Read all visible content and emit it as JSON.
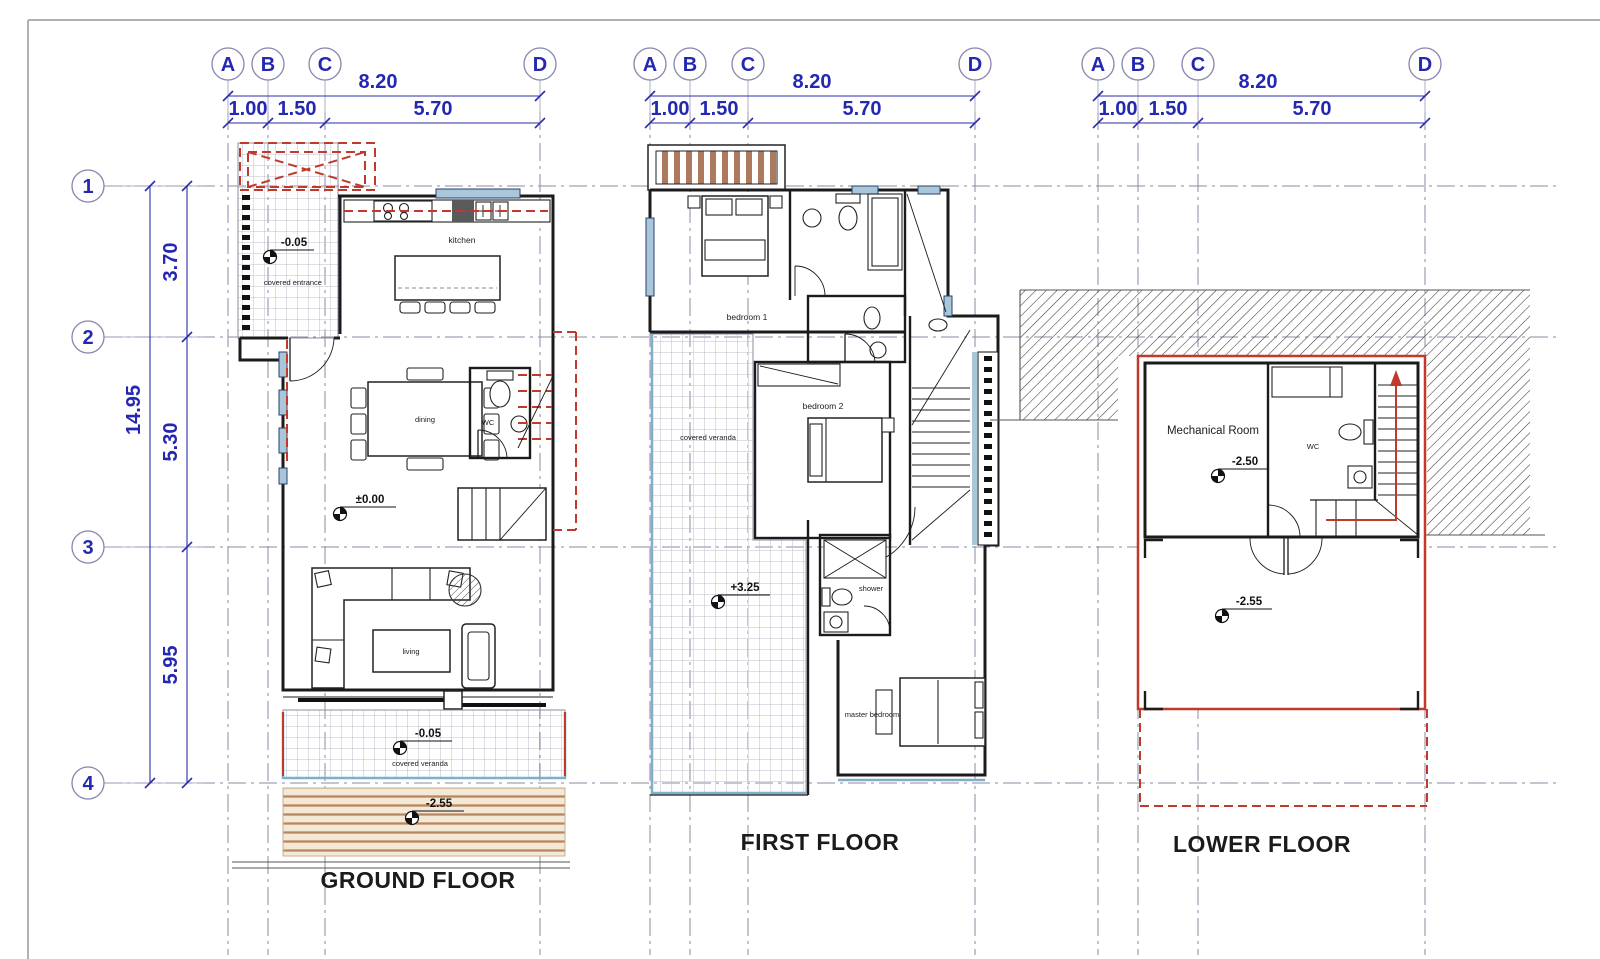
{
  "colors": {
    "dimension_blue": "#2427b2",
    "grid_dashdot": "#8b8ba6",
    "wall_black": "#1b1b1b",
    "red_accent": "#c0392b",
    "window_blue": "#a9c7d8",
    "veranda_blue": "#7fb0c8",
    "wood_tan": "#b5805a",
    "deck_cream": "#f4e8d7"
  },
  "grid": {
    "columns": [
      "A",
      "B",
      "C",
      "D"
    ],
    "rows": [
      "1",
      "2",
      "3",
      "4"
    ],
    "column_dims": {
      "total": "8.20",
      "segments": [
        "1.00",
        "1.50",
        "5.70"
      ]
    },
    "row_dims": {
      "total": "14.95",
      "segments": [
        "3.70",
        "5.30",
        "5.95"
      ]
    }
  },
  "floors": {
    "ground": {
      "title": "GROUND FLOOR",
      "rooms": {
        "kitchen": "kitchen",
        "dining": "dining",
        "wc": "WC",
        "living": "living",
        "covered_entrance": "covered entrance",
        "covered_veranda": "covered veranda"
      },
      "levels": {
        "entrance": "-0.05",
        "main": "±0.00",
        "veranda": "-0.05",
        "deck": "-2.55"
      }
    },
    "first": {
      "title": "FIRST FLOOR",
      "rooms": {
        "bedroom1": "bedroom 1",
        "bedroom2": "bedroom 2",
        "shower": "shower",
        "master": "master bedroom",
        "covered_veranda": "covered veranda"
      },
      "levels": {
        "veranda": "+3.25"
      }
    },
    "lower": {
      "title": "LOWER FLOOR",
      "rooms": {
        "mechanical": "Mechanical Room",
        "wc": "WC"
      },
      "levels": {
        "mechanical": "-2.50",
        "terrace": "-2.55"
      }
    }
  }
}
